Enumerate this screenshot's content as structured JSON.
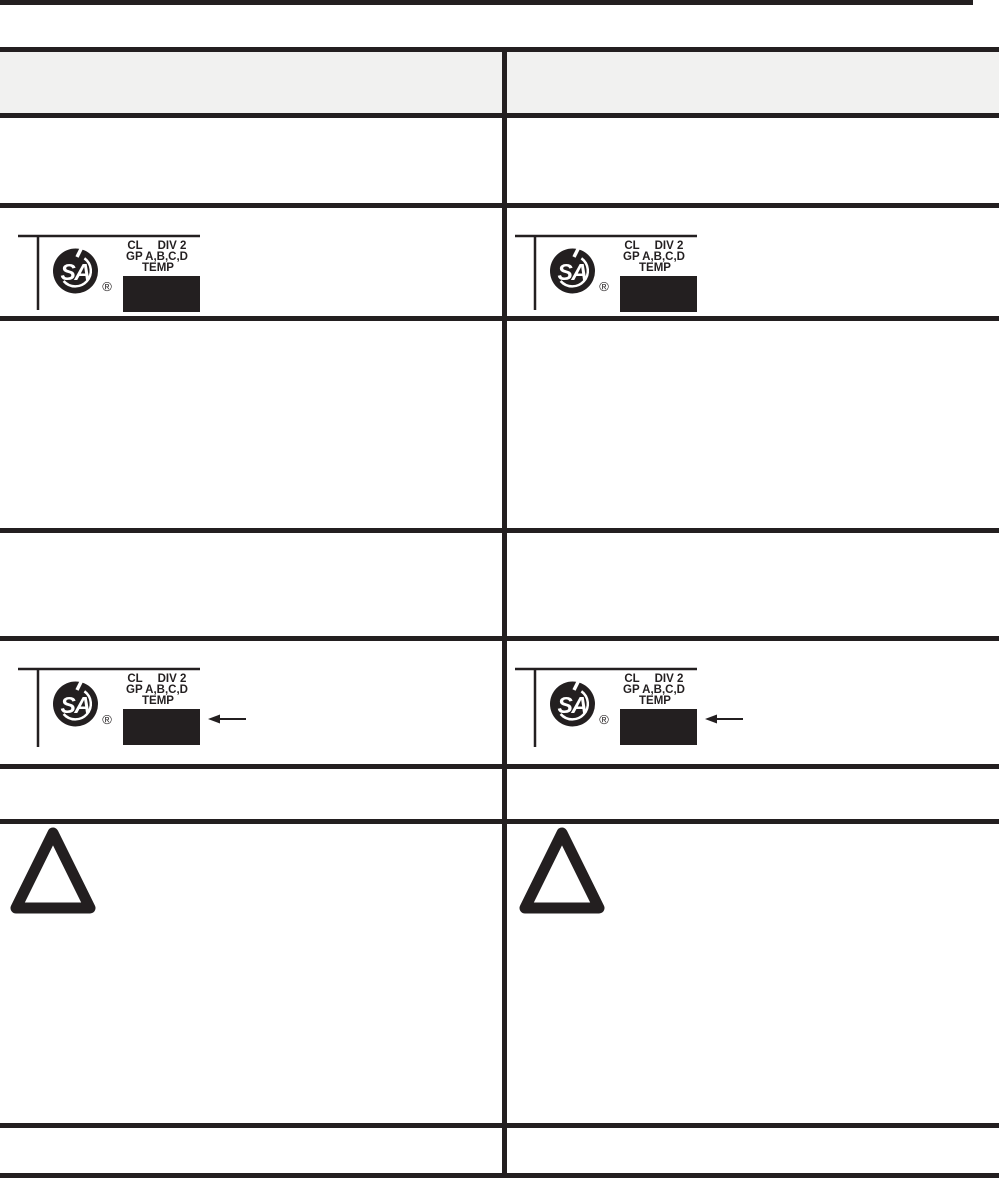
{
  "page": {
    "colors": {
      "ink": "#231f20",
      "header_bg": "#f1f1f0",
      "background": "#ffffff"
    }
  },
  "table": {
    "header": {
      "left": "",
      "right": ""
    },
    "rows": [
      {
        "name": "header-row",
        "left_content": "",
        "right_content": ""
      },
      {
        "name": "row-1",
        "left_content": "empty",
        "right_content": "empty"
      },
      {
        "name": "row-2",
        "left_content": "csa-certification-mark",
        "right_content": "csa-certification-mark"
      },
      {
        "name": "row-3",
        "left_content": "empty",
        "right_content": "empty"
      },
      {
        "name": "row-4",
        "left_content": "empty",
        "right_content": "empty"
      },
      {
        "name": "row-5",
        "left_content": "csa-certification-mark-with-arrow",
        "right_content": "csa-certification-mark-with-arrow"
      },
      {
        "name": "row-6",
        "left_content": "empty",
        "right_content": "empty"
      },
      {
        "name": "row-7",
        "left_content": "warning-triangle",
        "right_content": "warning-triangle"
      },
      {
        "name": "row-8",
        "left_content": "empty",
        "right_content": "empty"
      }
    ]
  },
  "csa_mark": {
    "monogram": "SA",
    "registered": "®",
    "class_label": "CL",
    "division_label": "DIV 2",
    "group_label": "GP A,B,C,D",
    "temp_label": "TEMP"
  },
  "icons": {
    "csa_logo": "csa-logo-icon",
    "registered_trademark": "registered-trademark-icon",
    "black_label_box": "black-label-box",
    "arrow_left": "arrow-left-icon",
    "warning_triangle": "warning-triangle-icon"
  }
}
